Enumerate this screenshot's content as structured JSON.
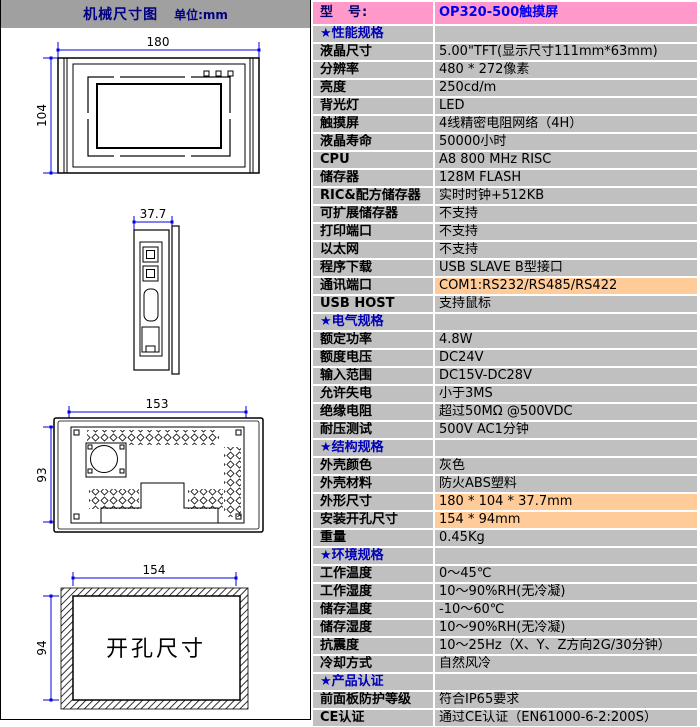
{
  "left_panel": {
    "title": "机械尺寸图",
    "unit_label": "单位:mm",
    "drawings": {
      "front_view": {
        "width_dim": "180",
        "height_dim": "104"
      },
      "side_view": {
        "depth_dim": "37.7"
      },
      "rear_view": {
        "width_dim": "153",
        "height_dim": "93"
      },
      "cutout_view": {
        "width_dim": "154",
        "height_dim": "94",
        "label": "开孔尺寸"
      }
    }
  },
  "spec_table": {
    "rows": [
      {
        "label": "型　号:",
        "value": "OP320-500触摸屏",
        "type": "model"
      },
      {
        "label": "★性能规格",
        "value": "",
        "type": "section"
      },
      {
        "label": "液晶尺寸",
        "value": "5.00\"TFT(显示尺寸111mm*63mm)",
        "type": "normal"
      },
      {
        "label": "分辨率",
        "value": "480 * 272像素",
        "type": "normal"
      },
      {
        "label": "亮度",
        "value": "250cd/m",
        "type": "normal"
      },
      {
        "label": "背光灯",
        "value": "LED",
        "type": "normal"
      },
      {
        "label": "触摸屏",
        "value": "4线精密电阻网络（4H）",
        "type": "normal"
      },
      {
        "label": "液晶寿命",
        "value": "50000小时",
        "type": "normal"
      },
      {
        "label": "CPU",
        "value": "A8 800 MHz RISC",
        "type": "normal"
      },
      {
        "label": "储存器",
        "value": "128M FLASH",
        "type": "normal"
      },
      {
        "label": "RIC&配方储存器",
        "value": "实时时钟+512KB",
        "type": "normal"
      },
      {
        "label": "可扩展储存器",
        "value": "不支持",
        "type": "normal"
      },
      {
        "label": "打印端口",
        "value": "不支持",
        "type": "normal"
      },
      {
        "label": "以太网",
        "value": "不支持",
        "type": "normal"
      },
      {
        "label": "程序下载",
        "value": "USB SLAVE B型接口",
        "type": "normal"
      },
      {
        "label": "通讯端口",
        "value": "COM1:RS232/RS485/RS422",
        "type": "normal",
        "highlight": true
      },
      {
        "label": "USB HOST",
        "value": "支持鼠标",
        "type": "normal"
      },
      {
        "label": "★电气规格",
        "value": "",
        "type": "section"
      },
      {
        "label": "额定功率",
        "value": "4.8W",
        "type": "normal"
      },
      {
        "label": "额度电压",
        "value": "DC24V",
        "type": "normal"
      },
      {
        "label": "输入范围",
        "value": "DC15V-DC28V",
        "type": "normal"
      },
      {
        "label": "允许失电",
        "value": "小于3MS",
        "type": "normal"
      },
      {
        "label": "绝缘电阻",
        "value": "超过50MΩ @500VDC",
        "type": "normal"
      },
      {
        "label": "耐压测试",
        "value": "500V AC1分钟",
        "type": "normal"
      },
      {
        "label": "★结构规格",
        "value": "",
        "type": "section"
      },
      {
        "label": "外壳颜色",
        "value": "灰色",
        "type": "normal"
      },
      {
        "label": "外壳材料",
        "value": "防火ABS塑料",
        "type": "normal"
      },
      {
        "label": "外形尺寸",
        "value": "180 * 104 * 37.7mm",
        "type": "normal",
        "highlight": true
      },
      {
        "label": "安装开孔尺寸",
        "value": "154 * 94mm",
        "type": "normal",
        "highlight": true
      },
      {
        "label": "重量",
        "value": "0.45Kg",
        "type": "normal"
      },
      {
        "label": "★环境规格",
        "value": "",
        "type": "section"
      },
      {
        "label": "工作温度",
        "value": "0～45℃",
        "type": "normal"
      },
      {
        "label": "工作湿度",
        "value": "10～90%RH(无冷凝)",
        "type": "normal"
      },
      {
        "label": "储存温度",
        "value": "-10～60℃",
        "type": "normal"
      },
      {
        "label": "储存湿度",
        "value": "10～90%RH(无冷凝)",
        "type": "normal"
      },
      {
        "label": "抗震度",
        "value": "10～25Hz（X、Y、Z方向2G/30分钟）",
        "type": "normal"
      },
      {
        "label": "冷却方式",
        "value": "自然风冷",
        "type": "normal"
      },
      {
        "label": "★产品认证",
        "value": "",
        "type": "section"
      },
      {
        "label": "前面板防护等级",
        "value": "符合IP65要求",
        "type": "normal"
      },
      {
        "label": "CE认证",
        "value": "通过CE认证（EN61000-6-2:200S）",
        "type": "normal"
      }
    ]
  },
  "colors": {
    "table_row_bg": "#C0C0C0",
    "model_row_bg": "#FF99CC",
    "highlight_value_bg": "#FFCC99",
    "section_text": "#0000BB",
    "model_value_text": "#0000EE",
    "panel_header_bg": "#A0A0A0",
    "panel_header_text": "#000080",
    "dimension_line": "#0000E0"
  }
}
